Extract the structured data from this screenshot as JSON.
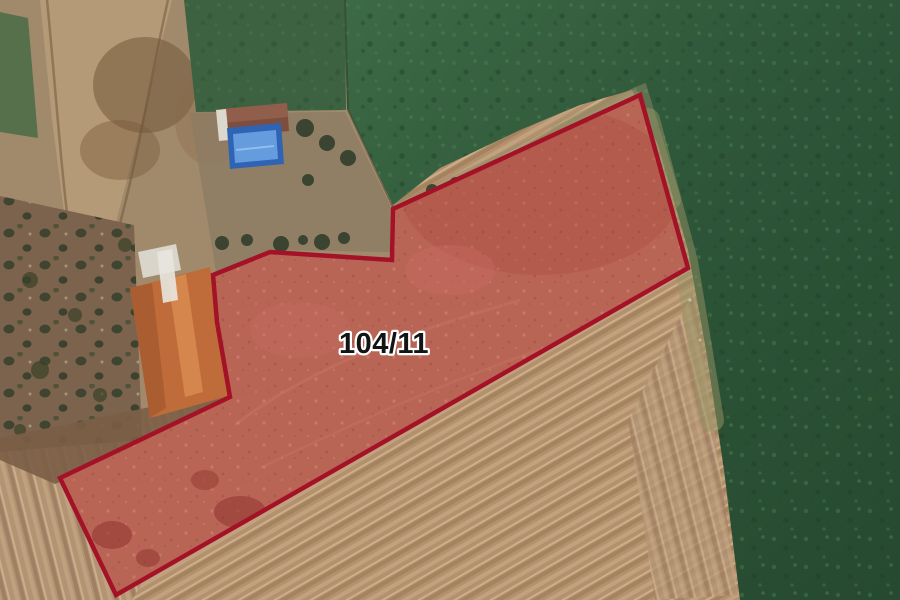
{
  "map": {
    "parcel": {
      "label": "104/11",
      "outline_points": "640,95 688,268 116,595 60,478 230,397 217,322 213,275 270,252 392,260 393,209"
    },
    "colors": {
      "parcel_stroke": "#a31226",
      "parcel_fill_overlay": "rgba(206,52,54,0.37)",
      "parcel_ground": "#ad8269",
      "parcel_label_fill": "#141414",
      "parcel_label_halo": "#ffffff",
      "plowed_field_tan": "#b3916e",
      "green_field": "#2e5639",
      "lawn_green": "#3d6241",
      "olive_grove_ground": "#7c634e",
      "dirt_road_tan": "#b49a76",
      "warehouse_roof_orange": "#bf6c3a",
      "house_roof_brown": "#7d4e3e",
      "pool_blue": "#2f63b4"
    }
  }
}
